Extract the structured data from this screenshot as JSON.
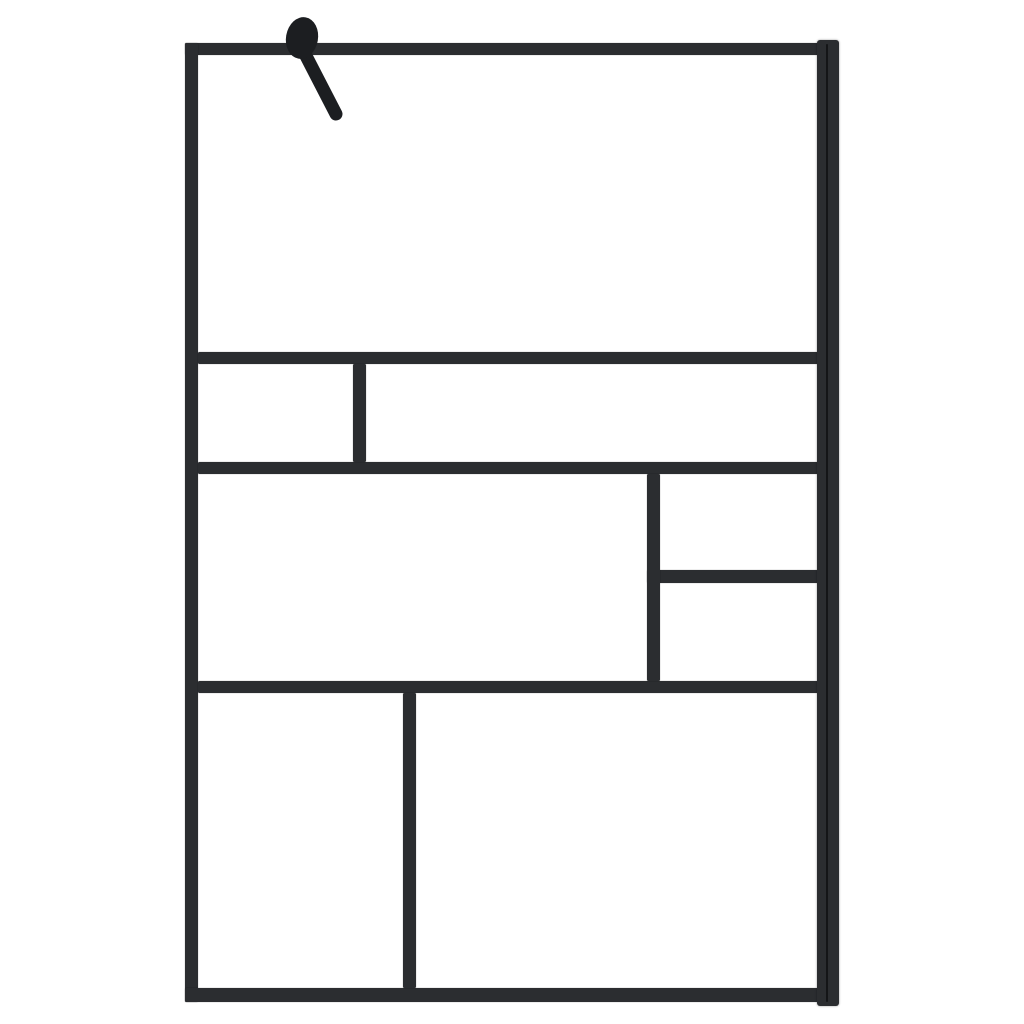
{
  "scene": {
    "title": "Walk-in shower screen with black frame - product photo",
    "background_color": "#ffffff"
  },
  "screen": {
    "frame_color": "#2b2d30",
    "hardware_color": "#1c1e21",
    "seam_color": "#141517",
    "glass_color": "#ffffff",
    "bars": [
      {
        "name": "frame-top-bar",
        "x": 185,
        "y": 43,
        "w": 634,
        "h": 12
      },
      {
        "name": "frame-left-bar",
        "x": 185,
        "y": 43,
        "w": 13,
        "h": 959
      },
      {
        "name": "frame-bottom-bar",
        "x": 185,
        "y": 988,
        "w": 634,
        "h": 14
      },
      {
        "name": "muntin-h1",
        "x": 198,
        "y": 352,
        "w": 620,
        "h": 12
      },
      {
        "name": "muntin-h2",
        "x": 198,
        "y": 462,
        "w": 620,
        "h": 12
      },
      {
        "name": "muntin-h3-right",
        "x": 647,
        "y": 570,
        "w": 171,
        "h": 13
      },
      {
        "name": "muntin-h4",
        "x": 198,
        "y": 681,
        "w": 620,
        "h": 12
      },
      {
        "name": "muntin-v1-row2",
        "x": 353,
        "y": 364,
        "w": 13,
        "h": 98
      },
      {
        "name": "muntin-v2-row3",
        "x": 647,
        "y": 474,
        "w": 13,
        "h": 207
      },
      {
        "name": "muntin-v3-row4",
        "x": 403,
        "y": 693,
        "w": 13,
        "h": 295
      }
    ],
    "wall_profile": {
      "name": "wall-profile",
      "x": 817,
      "y": 40,
      "w": 22,
      "h": 966
    },
    "wall_profile_seam": {
      "name": "wall-profile-seam",
      "x": 826,
      "y": 44,
      "w": 2,
      "h": 958
    },
    "panes": [
      {
        "name": "glass-pane-top",
        "x": 198,
        "y": 55,
        "w": 619,
        "h": 297
      },
      {
        "name": "glass-pane-row2-left",
        "x": 198,
        "y": 364,
        "w": 155,
        "h": 98
      },
      {
        "name": "glass-pane-row2-right",
        "x": 366,
        "y": 364,
        "w": 451,
        "h": 98
      },
      {
        "name": "glass-pane-row3-left",
        "x": 198,
        "y": 474,
        "w": 449,
        "h": 207
      },
      {
        "name": "glass-pane-row3-right-top",
        "x": 660,
        "y": 474,
        "w": 157,
        "h": 96
      },
      {
        "name": "glass-pane-row3-right-bottom",
        "x": 660,
        "y": 583,
        "w": 157,
        "h": 98
      },
      {
        "name": "glass-pane-row4-left",
        "x": 198,
        "y": 693,
        "w": 205,
        "h": 295
      },
      {
        "name": "glass-pane-row4-right",
        "x": 416,
        "y": 693,
        "w": 401,
        "h": 295
      }
    ],
    "support_arm": {
      "knob": {
        "cx": 302,
        "cy": 38,
        "rx": 16,
        "ry": 21,
        "rotate": 10
      },
      "arm": {
        "x1": 304,
        "y1": 52,
        "x2": 336,
        "y2": 114,
        "width": 13
      }
    }
  }
}
